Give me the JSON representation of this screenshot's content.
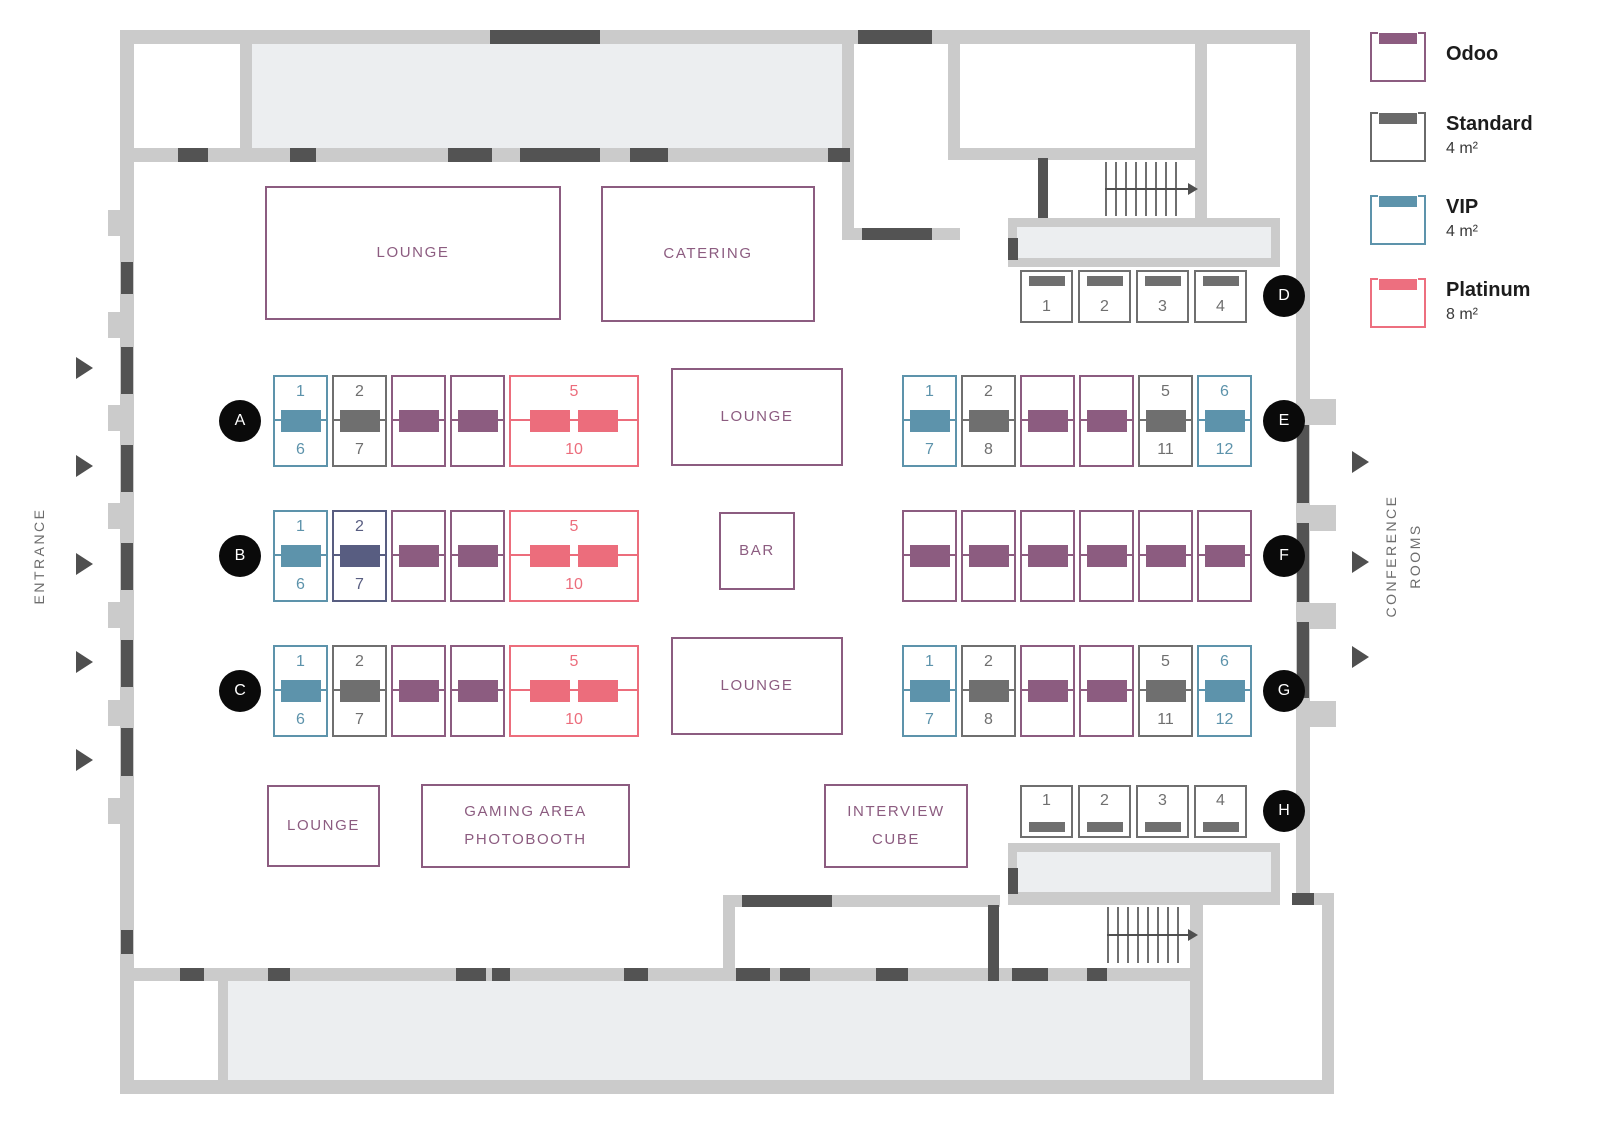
{
  "legend": {
    "items": [
      {
        "name": "Odoo",
        "size": "",
        "color": "#8c5c80"
      },
      {
        "name": "Standard",
        "size": "4 m²",
        "color": "#6a6a6a"
      },
      {
        "name": "VIP",
        "size": "4 m²",
        "color": "#5d93ab"
      },
      {
        "name": "Platinum",
        "size": "8 m²",
        "color": "#ed6f7f"
      }
    ]
  },
  "booth_types": {
    "odoo": {
      "color": "#8c5c80"
    },
    "standard": {
      "color": "#6f6f6f"
    },
    "vip": {
      "color": "#5d93ab"
    },
    "platinum": {
      "color": "#ec6d7c"
    },
    "reserved": {
      "color": "#585d81"
    }
  },
  "palette": {
    "wall": "#cbcbcb",
    "door_dark": "#535353",
    "room_fill": "#eceef0",
    "marker_bg": "#0a0a0a",
    "area_purple": "#8c5c80"
  },
  "side_labels": {
    "left": "ENTRANCE",
    "right": "CONFERENCE\nROOMS"
  },
  "icons": {
    "direction_arrow": "right-triangle",
    "stairs_arrow": "right-arrow-over-treads"
  },
  "areas": [
    {
      "id": "lounge-top",
      "label": "LOUNGE"
    },
    {
      "id": "catering",
      "label": "CATERING"
    },
    {
      "id": "lounge-mid-a",
      "label": "LOUNGE"
    },
    {
      "id": "bar",
      "label": "BAR"
    },
    {
      "id": "lounge-mid-c",
      "label": "LOUNGE"
    },
    {
      "id": "lounge-bottom",
      "label": "LOUNGE"
    },
    {
      "id": "gaming-area",
      "label": "GAMING AREA\nPHOTOBOOTH"
    },
    {
      "id": "interview-cube",
      "label": "INTERVIEW\nCUBE"
    }
  ],
  "rows": {
    "A": {
      "letter": "A",
      "booths": [
        {
          "type": "vip",
          "top": "1",
          "bottom": "6"
        },
        {
          "type": "standard",
          "top": "2",
          "bottom": "7"
        },
        {
          "type": "odoo"
        },
        {
          "type": "odoo"
        },
        {
          "type": "platinum",
          "top": "5",
          "bottom": "10",
          "wide": true
        }
      ]
    },
    "B": {
      "letter": "B",
      "booths": [
        {
          "type": "vip",
          "top": "1",
          "bottom": "6"
        },
        {
          "type": "reserved",
          "top": "2",
          "bottom": "7"
        },
        {
          "type": "odoo"
        },
        {
          "type": "odoo"
        },
        {
          "type": "platinum",
          "top": "5",
          "bottom": "10",
          "wide": true
        }
      ]
    },
    "C": {
      "letter": "C",
      "booths": [
        {
          "type": "vip",
          "top": "1",
          "bottom": "6"
        },
        {
          "type": "standard",
          "top": "2",
          "bottom": "7"
        },
        {
          "type": "odoo"
        },
        {
          "type": "odoo"
        },
        {
          "type": "platinum",
          "top": "5",
          "bottom": "10",
          "wide": true
        }
      ]
    },
    "D": {
      "letter": "D",
      "booths": [
        {
          "type": "standard",
          "label": "1"
        },
        {
          "type": "standard",
          "label": "2"
        },
        {
          "type": "standard",
          "label": "3"
        },
        {
          "type": "standard",
          "label": "4"
        }
      ]
    },
    "E": {
      "letter": "E",
      "booths": [
        {
          "type": "vip",
          "top": "1",
          "bottom": "7"
        },
        {
          "type": "standard",
          "top": "2",
          "bottom": "8"
        },
        {
          "type": "odoo"
        },
        {
          "type": "odoo"
        },
        {
          "type": "standard",
          "top": "5",
          "bottom": "11"
        },
        {
          "type": "vip",
          "top": "6",
          "bottom": "12"
        }
      ]
    },
    "F": {
      "letter": "F",
      "booths": [
        {
          "type": "odoo"
        },
        {
          "type": "odoo"
        },
        {
          "type": "odoo"
        },
        {
          "type": "odoo"
        },
        {
          "type": "odoo"
        },
        {
          "type": "odoo"
        }
      ]
    },
    "G": {
      "letter": "G",
      "booths": [
        {
          "type": "vip",
          "top": "1",
          "bottom": "7"
        },
        {
          "type": "standard",
          "top": "2",
          "bottom": "8"
        },
        {
          "type": "odoo"
        },
        {
          "type": "odoo"
        },
        {
          "type": "standard",
          "top": "5",
          "bottom": "11"
        },
        {
          "type": "vip",
          "top": "6",
          "bottom": "12"
        }
      ]
    },
    "H": {
      "letter": "H",
      "booths": [
        {
          "type": "standard",
          "label": "1"
        },
        {
          "type": "standard",
          "label": "2"
        },
        {
          "type": "standard",
          "label": "3"
        },
        {
          "type": "standard",
          "label": "4"
        }
      ]
    }
  }
}
